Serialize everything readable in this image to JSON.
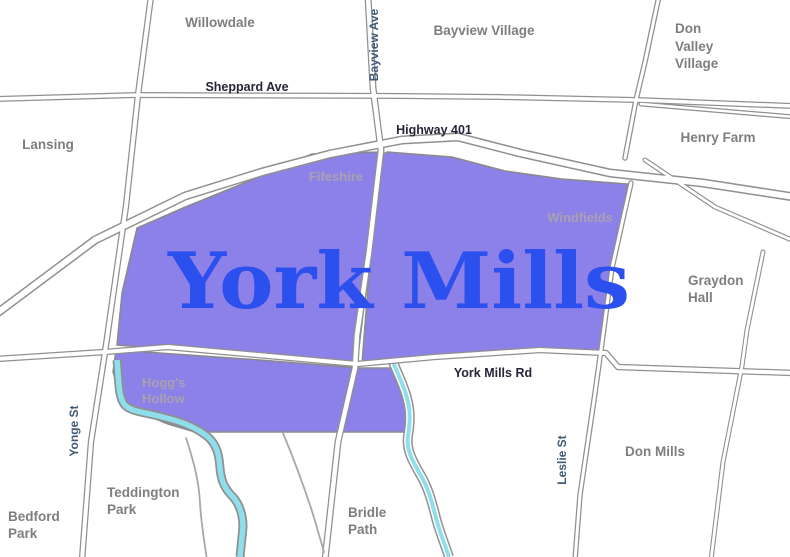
{
  "map": {
    "main_region_label": "York Mills",
    "sub_region_labels": {
      "fifeshire": "Fifeshire",
      "windfields": "Windfields",
      "hoggs_hollow_line1": "Hogg's",
      "hoggs_hollow_line2": "Hollow"
    },
    "neighborhood_labels": {
      "willowdale": "Willowdale",
      "bayview_village": "Bayview Village",
      "don_valley_village_line1": "Don",
      "don_valley_village_line2": "Valley",
      "don_valley_village_line3": "Village",
      "lansing": "Lansing",
      "henry_farm": "Henry Farm",
      "graydon_hall_line1": "Graydon",
      "graydon_hall_line2": "Hall",
      "don_mills": "Don Mills",
      "teddington_park_line1": "Teddington",
      "teddington_park_line2": "Park",
      "bedford_park_line1": "Bedford",
      "bedford_park_line2": "Park",
      "bridle_path_line1": "Bridle",
      "bridle_path_line2": "Path"
    },
    "road_labels": {
      "sheppard_ave": "Sheppard Ave",
      "highway_401": "Highway 401",
      "york_mills_rd": "York Mills Rd",
      "bayview_ave": "Bayview Ave",
      "yonge_st": "Yonge St",
      "leslie_st": "Leslie St"
    },
    "colors": {
      "region_fill": "#8c81e9",
      "region_border": "#8a8a8a",
      "region_label_text": "#2b50ee",
      "river": "#8edfeb",
      "road_casing": "#909090",
      "land": "#ffffff",
      "neighborhood_text": "#7e7e7e",
      "sub_region_text": "#a9a1b0",
      "road_label_text": "#26263a",
      "street_label_text": "#3f5a78"
    }
  }
}
